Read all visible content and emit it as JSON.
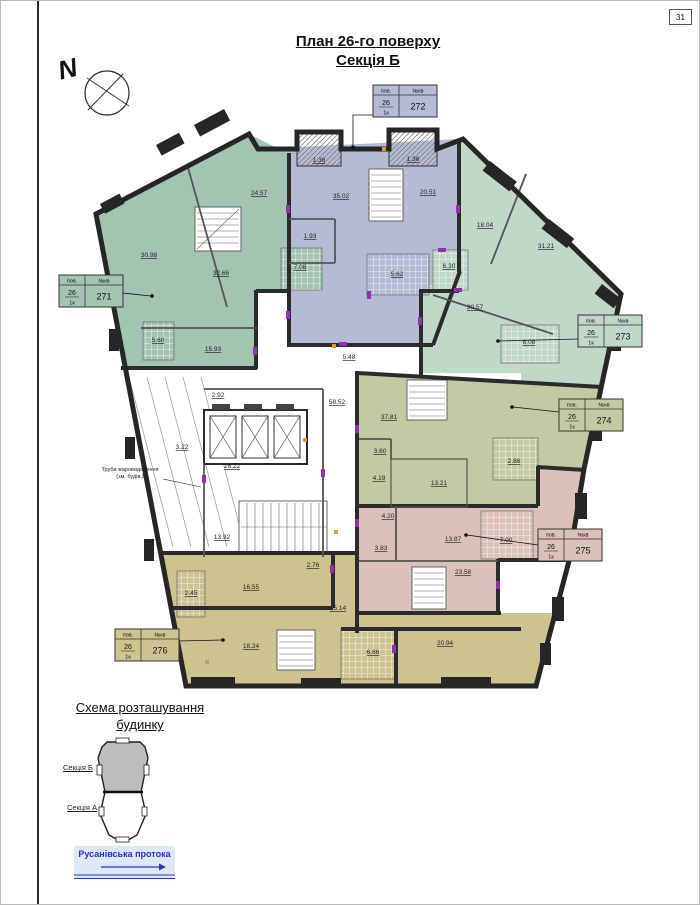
{
  "page": {
    "number": "31"
  },
  "title": {
    "line1": "План 26-го поверху",
    "line2": "Секція Б"
  },
  "compass": {
    "label": "N"
  },
  "tags": {
    "header_floor": "пов.",
    "header_unit": "№кв",
    "floor": "26",
    "unit_type": "1к",
    "items": [
      {
        "number": "271"
      },
      {
        "number": "272"
      },
      {
        "number": "273"
      },
      {
        "number": "274"
      },
      {
        "number": "275"
      },
      {
        "number": "276"
      }
    ]
  },
  "apartments": {
    "a271": {
      "color": "#a4c3b1"
    },
    "a272": {
      "color": "#b5bbd3"
    },
    "a273": {
      "color": "#c1d7c8"
    },
    "a274": {
      "color": "#c4c8a4"
    },
    "a275": {
      "color": "#dac2bb"
    },
    "a276": {
      "color": "#cdc391"
    }
  },
  "rooms": {
    "a271_r1": "30.98",
    "a271_r2": "32.66",
    "a271_r3": "24.57",
    "a271_r4": "15.93",
    "a271_bath": "7.08",
    "a271_b1": "5.60",
    "a272_r1": "35.02",
    "a272_r2": "20.51",
    "a272_h": "1.93",
    "a272_bath": "5.62",
    "a272_balc1": "1.36",
    "a272_balc2": "1.36",
    "a273_r1": "18.04",
    "a273_r2": "31.21",
    "a273_r3": "30.57",
    "a273_bath": "6.30",
    "a273_balc": "8.08",
    "a274_r1": "37.81",
    "a274_h1": "3.60",
    "a274_h2": "4.19",
    "a274_r2": "13.21",
    "a274_h3": "4.20",
    "a274_balc": "2.86",
    "a275_r1": "13.87",
    "a275_balc": "7.00",
    "a275_h1": "3.83",
    "a275_r2": "23.58",
    "a276_r1": "16.55",
    "a276_h": "15.14",
    "a276_r2": "18.24",
    "a276_r3": "20.94",
    "a276_bath": "6.86",
    "a276_balc": "2.45",
    "a276_wc": "2.76",
    "core_corr": "16.22",
    "core_st": "13.92",
    "core_shaft": "3.22",
    "core_h1": "2.92",
    "core_area": "58.52",
    "core_h2": "5.48"
  },
  "note": {
    "line1": "Труби жаровидалення",
    "line2": "(зм. будів.)"
  },
  "legend": {
    "title_line1": "Схема розташування",
    "title_line2": "будинку",
    "section_b": "Секція Б",
    "section_a": "Секція А",
    "river": "Русанівська протока"
  },
  "colors": {
    "wall": "#2b2b2b",
    "door_accent": "#8b35a8",
    "marker_accent": "#e2953f",
    "river": "#2433c8",
    "scheme_fill": "#bdbdbd"
  }
}
